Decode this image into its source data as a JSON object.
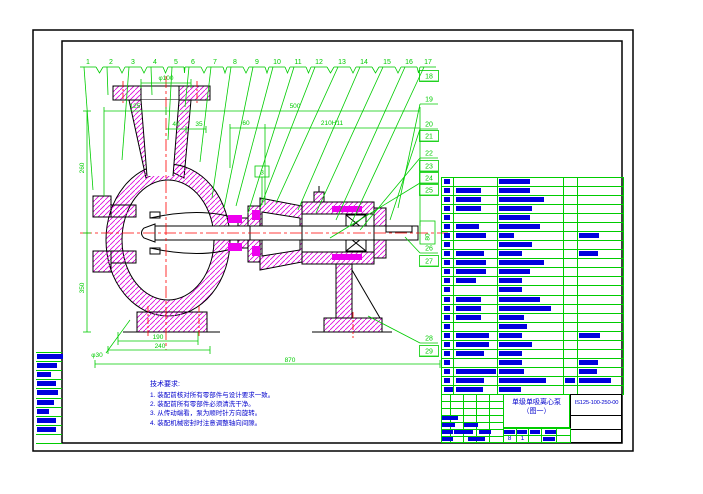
{
  "colors": {
    "line_green": "#00cc00",
    "text_blue": "#0000cc",
    "hatch_magenta": "#dd00dd",
    "centerline_red": "#ff0000",
    "outline_black": "#000000",
    "bar_blue": "#0000dd"
  },
  "balloons": {
    "top": [
      "1",
      "2",
      "3",
      "4",
      "5",
      "6",
      "7",
      "8",
      "9",
      "10",
      "11",
      "12",
      "13",
      "14",
      "15",
      "16",
      "17"
    ],
    "right": [
      {
        "label": "18",
        "boxed": true
      },
      {
        "label": "19",
        "boxed": false
      },
      {
        "label": "20",
        "boxed": false
      },
      {
        "label": "21",
        "boxed": true
      },
      {
        "label": "22",
        "boxed": false
      },
      {
        "label": "23",
        "boxed": true
      },
      {
        "label": "24",
        "boxed": true
      },
      {
        "label": "25",
        "boxed": true
      },
      {
        "label": "26",
        "boxed": false
      },
      {
        "label": "27",
        "boxed": true
      },
      {
        "label": "28",
        "boxed": false
      },
      {
        "label": "29",
        "boxed": true
      }
    ]
  },
  "dims": {
    "phi100": "φ100",
    "d125": "125",
    "d500": "500",
    "d60": "60",
    "d210": "210H11",
    "d40": "40",
    "d35": "35",
    "d260": "260",
    "d350": "350",
    "d190": "190",
    "d240": "240",
    "d870": "870",
    "phi30": "φ30",
    "d80": "80",
    "d3": "3"
  },
  "tech_req": {
    "title": "技术要求:",
    "items": [
      "1. 装配前核对所有零部件与设计要求一致。",
      "2. 装配前所有零部件必须清洗干净。",
      "3. 从传动端看，泵为顺时针方向旋转。",
      "4. 装配机械密封时注意调整轴向间隙。"
    ]
  },
  "bom": {
    "rows": [
      [
        6,
        0,
        31,
        0,
        0
      ],
      [
        6,
        25,
        31,
        0,
        0
      ],
      [
        6,
        25,
        45,
        0,
        0
      ],
      [
        6,
        25,
        33,
        0,
        0
      ],
      [
        6,
        0,
        31,
        0,
        0
      ],
      [
        6,
        23,
        41,
        0,
        0
      ],
      [
        6,
        30,
        15,
        0,
        20
      ],
      [
        6,
        0,
        33,
        0,
        0
      ],
      [
        6,
        28,
        23,
        0,
        19
      ],
      [
        6,
        30,
        45,
        0,
        0
      ],
      [
        6,
        30,
        31,
        0,
        0
      ],
      [
        6,
        20,
        23,
        0,
        0
      ],
      [
        6,
        0,
        23,
        0,
        0
      ],
      [
        6,
        25,
        41,
        0,
        0
      ],
      [
        6,
        25,
        52,
        0,
        0
      ],
      [
        6,
        25,
        25,
        0,
        0
      ],
      [
        6,
        0,
        28,
        0,
        0
      ],
      [
        6,
        33,
        23,
        0,
        21
      ],
      [
        6,
        33,
        33,
        0,
        0
      ],
      [
        6,
        28,
        23,
        0,
        0
      ],
      [
        6,
        0,
        23,
        0,
        19
      ],
      [
        6,
        40,
        25,
        0,
        18
      ],
      [
        6,
        28,
        47,
        10,
        32
      ],
      [
        10,
        27,
        22,
        0,
        0
      ]
    ]
  },
  "left_strip": {
    "rows": [
      26,
      20,
      14,
      19,
      21,
      17,
      12,
      19,
      19,
      0
    ]
  },
  "title_block": {
    "title": "单级单吸离心泵",
    "subtitle": "（图一）",
    "drawing_no": "IS125-100-250-00",
    "sheet_total": "8",
    "sheet_no": "1",
    "sig_bars": [
      [
        1,
        22,
        16
      ],
      [
        1,
        29,
        13
      ],
      [
        23,
        29,
        14
      ],
      [
        1,
        36,
        11
      ],
      [
        13,
        36,
        19
      ],
      [
        38,
        36,
        12
      ],
      [
        1,
        43,
        11
      ],
      [
        27,
        43,
        17
      ]
    ],
    "mid_bars": [
      [
        63,
        35.5,
        11
      ],
      [
        76,
        35.5,
        10
      ],
      [
        89,
        35.5,
        10
      ],
      [
        104,
        35.5,
        11
      ],
      [
        102,
        43,
        12
      ]
    ]
  }
}
